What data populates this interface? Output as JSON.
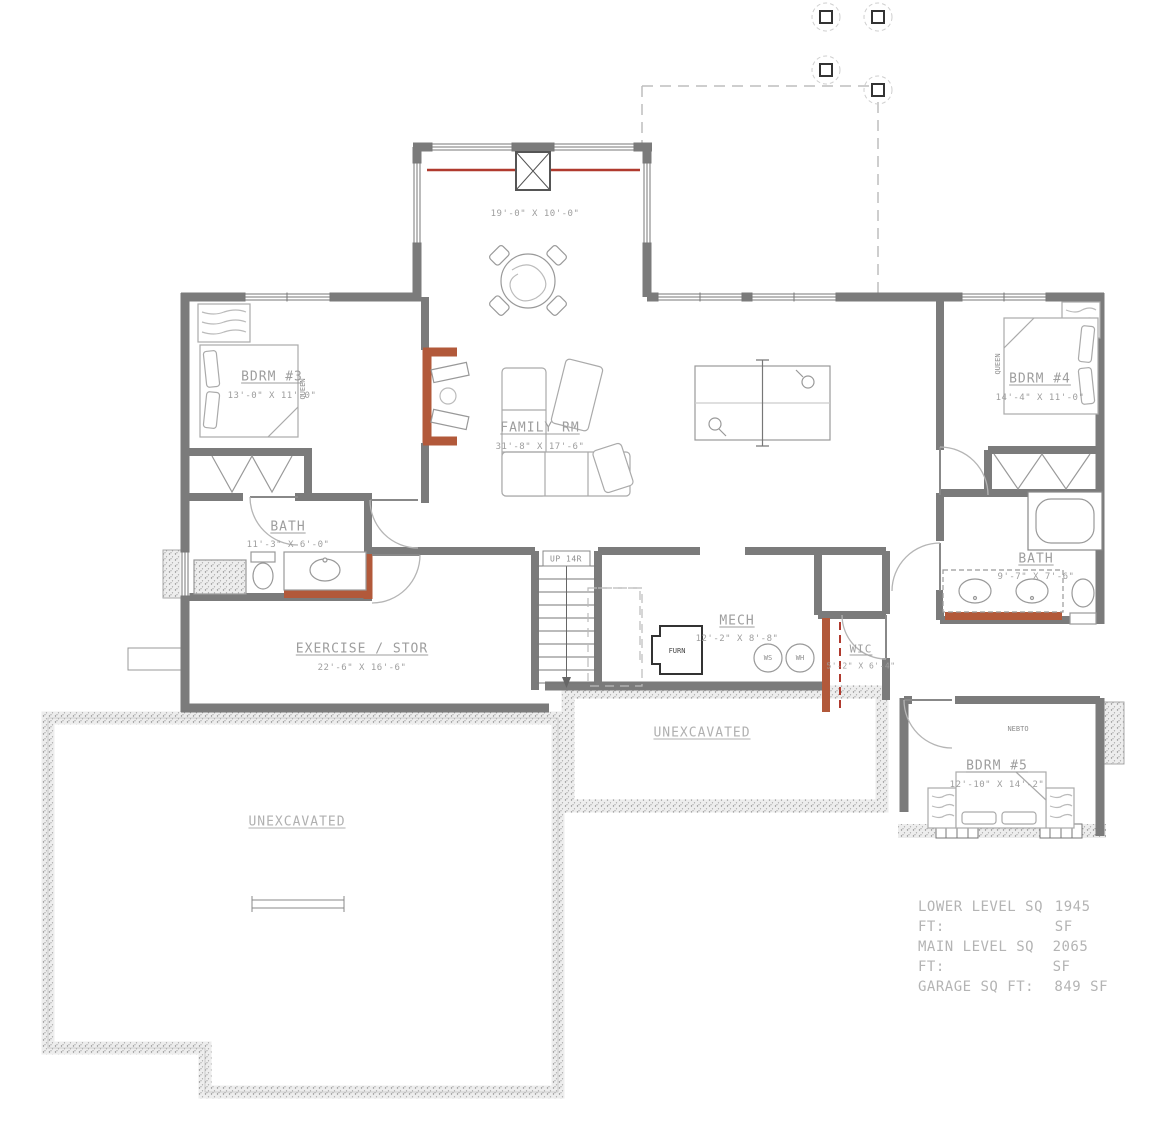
{
  "colors": {
    "wall_gray": "#7b7b7b",
    "accent_wall_orange": "#b2593a",
    "accent_line_red": "#b03a2e",
    "label_text": "#9e9e9e"
  },
  "rooms": {
    "family_rm": {
      "name": "FAMILY RM",
      "dims": "31'-8\" X 17'-6\""
    },
    "bdrm3": {
      "name": "BDRM #3",
      "dims": "13'-0\" X 11'-0\""
    },
    "bdrm4": {
      "name": "BDRM #4",
      "dims": "14'-4\" X 11'-0\""
    },
    "bdrm5": {
      "name": "BDRM #5",
      "dims": "12'-10\" X 14'-2\""
    },
    "bath_left": {
      "name": "BATH",
      "dims": "11'-3\" X 6'-0\""
    },
    "bath_right": {
      "name": "BATH",
      "dims": "9'-7\" X 7'-6\""
    },
    "exercise": {
      "name": "EXERCISE / STOR",
      "dims": "22'-6\" X 16'-6\""
    },
    "mech": {
      "name": "MECH",
      "dims": "12'-2\" X 8'-8\""
    },
    "wic": {
      "name": "WIC",
      "dims": "5'-2\" X 6'-4\""
    },
    "deck": {
      "dims": "19'-0\" X 10'-0\""
    },
    "unexcavated_left": "UNEXCAVATED",
    "unexcavated_center": "UNEXCAVATED"
  },
  "annotations": {
    "stairs": "UP 14R",
    "furnace": "FURN",
    "water_softener": "WS",
    "water_heater": "WH",
    "bed_left": "QUEEN",
    "bed_right": "QUEEN",
    "window_tag": "NEBTO"
  },
  "area_summary": {
    "rows": [
      {
        "label": "LOWER LEVEL SQ FT:",
        "value": "1945 SF"
      },
      {
        "label": "MAIN LEVEL SQ FT:",
        "value": "2065 SF"
      },
      {
        "label": "GARAGE SQ FT:",
        "value": "849 SF"
      }
    ]
  }
}
